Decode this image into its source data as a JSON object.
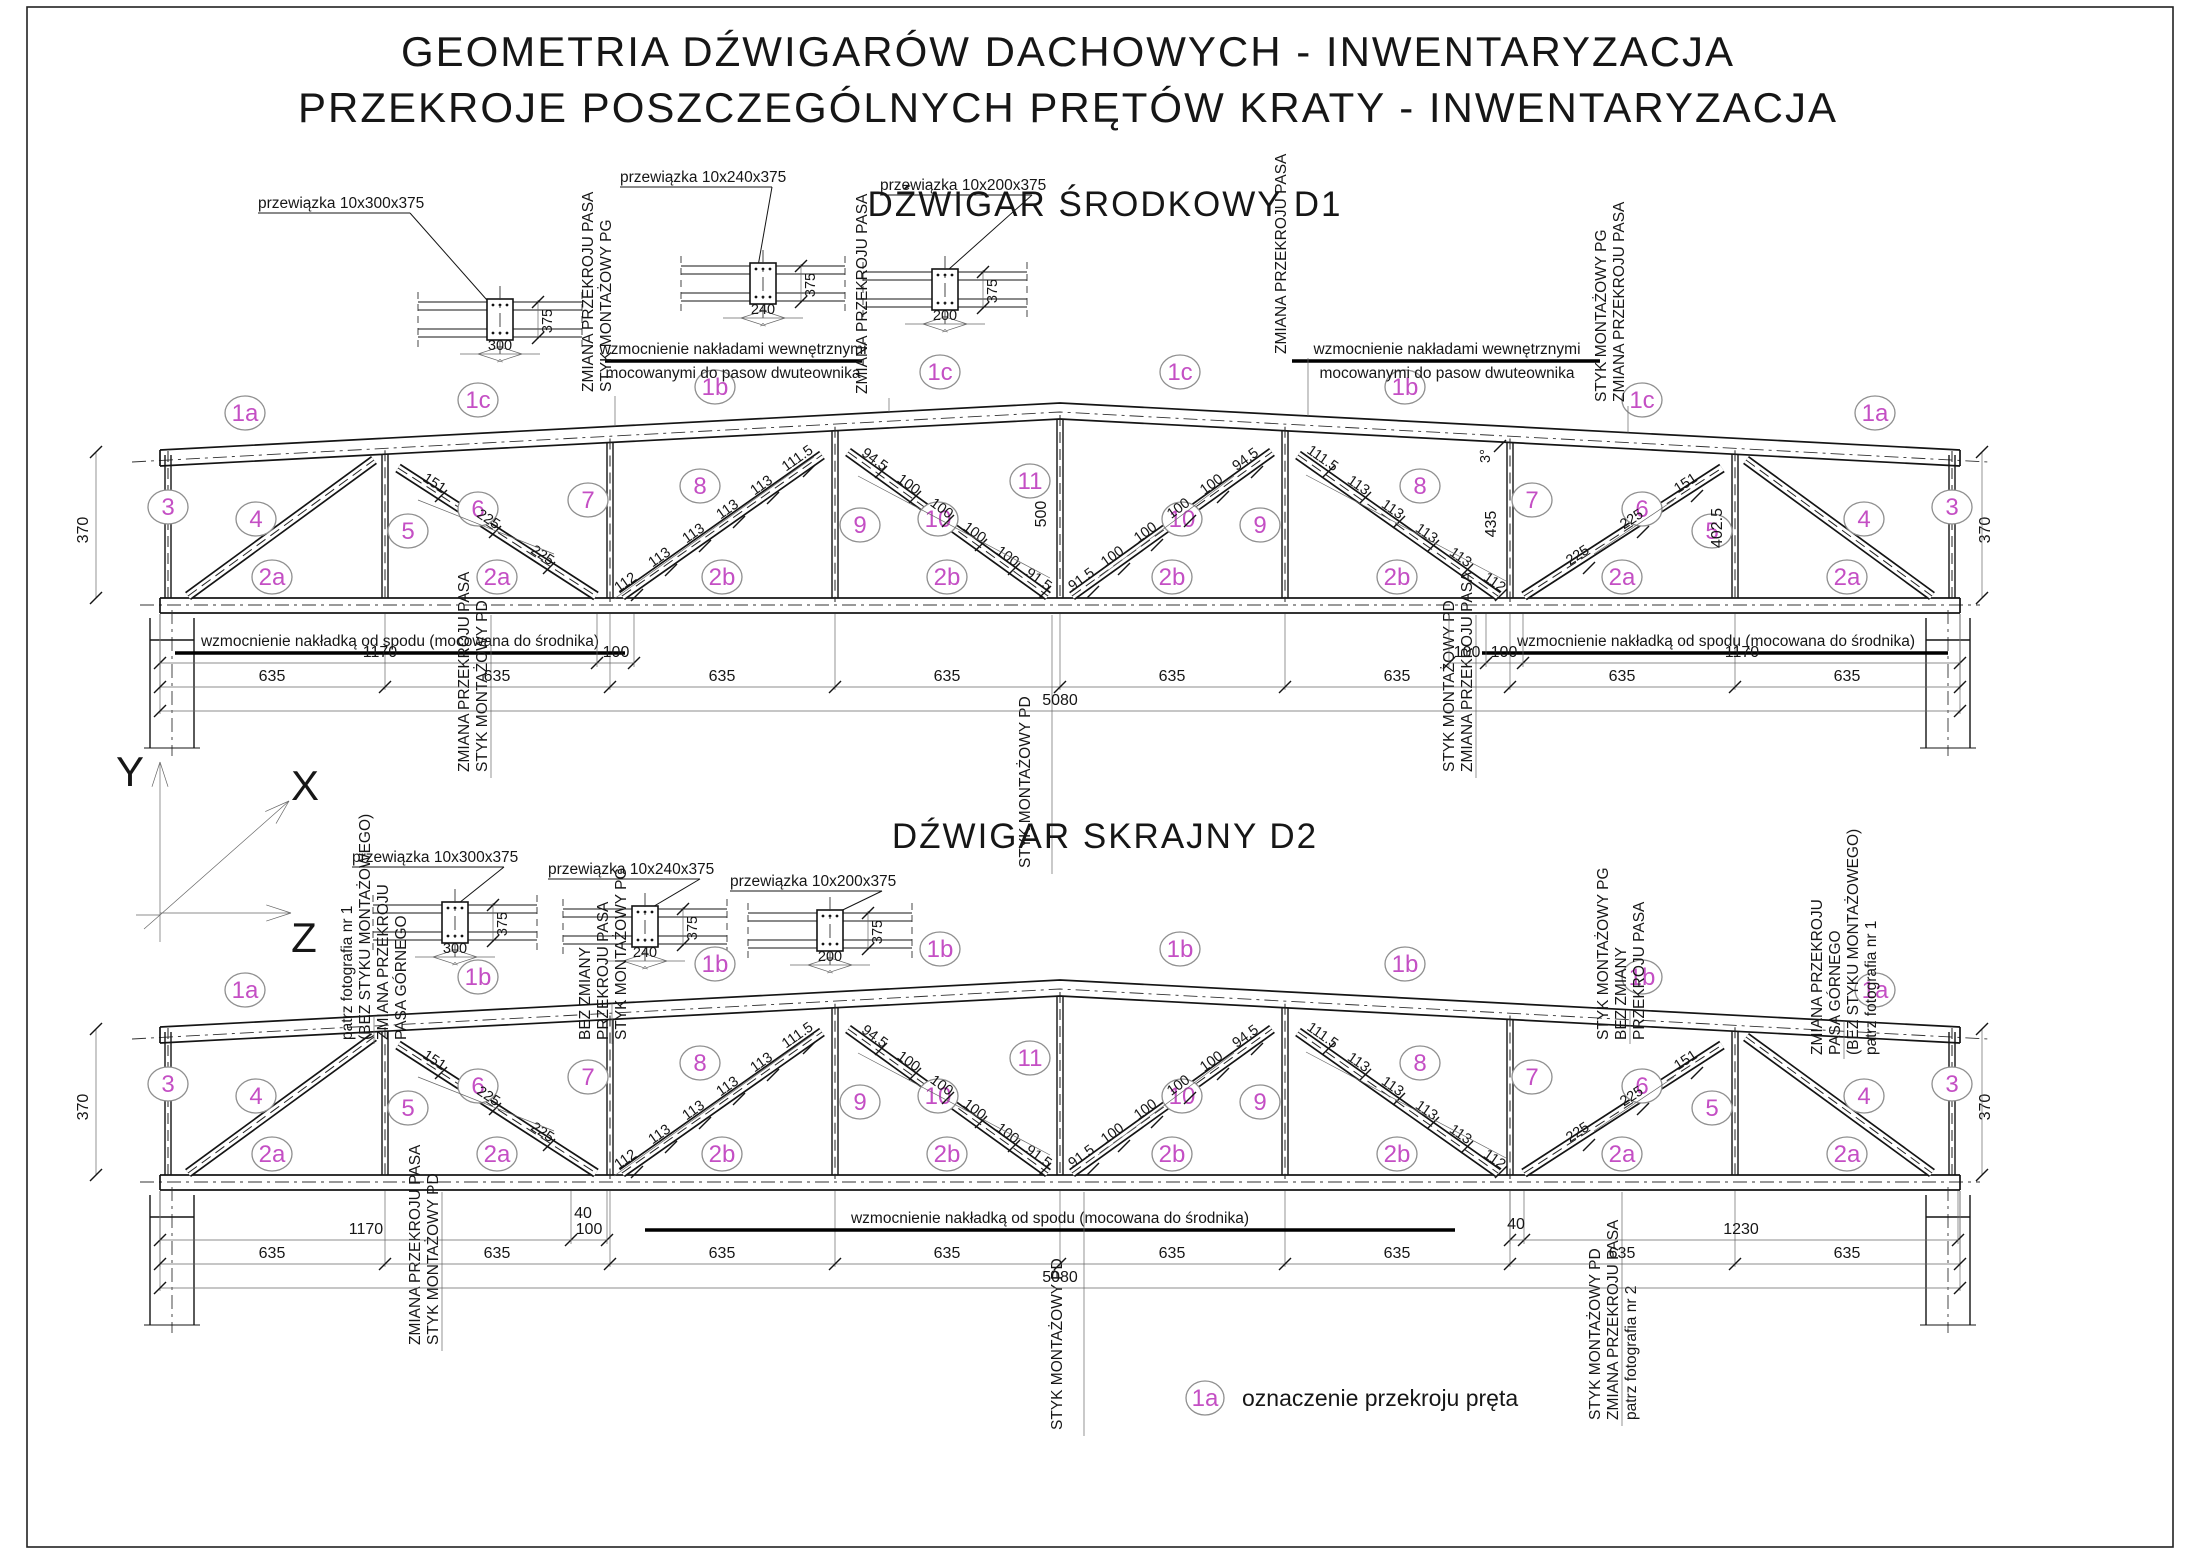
{
  "drawing": {
    "accent_color": "#c44fc4",
    "title_line1": "GEOMETRIA  DŹWIGARÓW  DACHOWYCH - INWENTARYZACJA",
    "title_line2": "PRZEKROJE POSZCZEGÓLNYCH  PRĘTÓW  KRATY - INWENTARYZACJA",
    "axes": {
      "y": "Y",
      "x": "X",
      "z": "Z"
    },
    "legend": {
      "bubble": "1a",
      "label": "oznaczenie  przekroju  pręta"
    }
  },
  "trusses": [
    {
      "name": "D1",
      "title": "DŹWIGAR  ŚRODKOWY  D1",
      "callouts": [
        {
          "label": "przewiązka 10x300x375",
          "width_dim": "300",
          "height_dim": "375"
        },
        {
          "label": "przewiązka 10x240x375",
          "width_dim": "240",
          "height_dim": "375"
        },
        {
          "label": "przewiązka 10x200x375",
          "width_dim": "200",
          "height_dim": "375"
        }
      ],
      "top_chord_labels": [
        "1a",
        "1c",
        "1b",
        "1c",
        "1c",
        "1b",
        "1c",
        "1a"
      ],
      "bottom_chord_labels": [
        "2a",
        "2a",
        "2b",
        "2b",
        "2b",
        "2b",
        "2a",
        "2a"
      ],
      "member_labels": [
        "3",
        "4",
        "5",
        "6",
        "7",
        "8",
        "9",
        "10",
        "11",
        "10",
        "9",
        "8",
        "7",
        "6",
        "5",
        "4",
        "3"
      ],
      "reinforce_top_note_l1": "wzmocnienie  nakładami  wewnętrznymi",
      "reinforce_top_note_l2": "mocowanymi do pasow dwuteownika",
      "reinforce_bottom_note": "wzmocnienie  nakładką od spodu (mocowana do środnika)",
      "vertical_notes": [
        [
          "ZMIANA PRZEKROJU PASA",
          "STYK  MONTAŻOWY  PG"
        ],
        [
          "ZMIANA  PRZEKROJU PASA"
        ],
        [
          "ZMIANA PRZEKROJU PASA"
        ],
        [
          "STYK  MONTAŻOWY  PG",
          "ZMIANA PRZEKROJU PASA"
        ],
        [
          "ZMIANA PRZEKROJU PASA",
          "STYK  MONTAŻOWY  PD"
        ],
        [
          "STYK  MONTAŻOWY  PD"
        ],
        [
          "STYK  MONTAŻOWY  PD",
          "ZMIANA PRZEKROJU PASA"
        ]
      ],
      "height_dims": [
        "370",
        "435",
        "500",
        "402.5",
        "370"
      ],
      "slope_dim": "3°",
      "batten_chains": {
        "left_diag_6": [
          "151",
          "225",
          "225"
        ],
        "left_diag_8": [
          "112",
          "113",
          "113",
          "113",
          "113",
          "111.5"
        ],
        "left_diag_10": [
          "94.5",
          "100",
          "100",
          "100",
          "100",
          "91.5"
        ],
        "right_diag_10": [
          "94.5",
          "100",
          "100",
          "100",
          "100",
          "91.5"
        ],
        "right_diag_8": [
          "111.5",
          "113",
          "113",
          "113",
          "113",
          "112"
        ],
        "right_diag_6": [
          "151",
          "225",
          "225"
        ]
      },
      "dim_rows": {
        "row1_left": [
          "1170",
          "100"
        ],
        "row1_right": [
          "100",
          "100",
          "1170"
        ],
        "row2": [
          "635",
          "635",
          "635",
          "635",
          "635",
          "635",
          "635",
          "635"
        ],
        "total": "5080"
      }
    },
    {
      "name": "D2",
      "title": "DŹWIGAR  SKRAJNY  D2",
      "callouts": [
        {
          "label": "przewiązka 10x300x375",
          "width_dim": "300",
          "height_dim": "375"
        },
        {
          "label": "przewiązka 10x240x375",
          "width_dim": "240",
          "height_dim": "375"
        },
        {
          "label": "przewiązka 10x200x375",
          "width_dim": "200",
          "height_dim": "375"
        }
      ],
      "top_chord_labels": [
        "1a",
        "1b",
        "1b",
        "1b",
        "1b",
        "1b",
        "1b",
        "1a"
      ],
      "bottom_chord_labels": [
        "2a",
        "2a",
        "2b",
        "2b",
        "2b",
        "2b",
        "2a",
        "2a"
      ],
      "member_labels": [
        "3",
        "4",
        "5",
        "6",
        "7",
        "8",
        "9",
        "10",
        "11",
        "10",
        "9",
        "8",
        "7",
        "6",
        "5",
        "4",
        "3"
      ],
      "reinforce_bottom_note": "wzmocnienie  nakładką od spodu (mocowana do środnika)",
      "vertical_notes": [
        [
          "patrz fotografia nr 1",
          "(BEZ  STYKU  MONTAŻOWEGO)",
          "ZMIANA PRZEKROJU",
          "PASA GÓRNEGO"
        ],
        [
          "BEZ ZMIANY",
          "PRZEKROJU PASA",
          "STYK  MONTAŻOWY  PG"
        ],
        [
          "STYK  MONTAŻOWY  PG",
          "BEZ ZMIANY",
          "PRZEKROJU PASA"
        ],
        [
          "ZMIANA PRZEKROJU",
          "PASA GÓRNEGO",
          "(BEZ  STYKU  MONTAŻOWEGO)",
          "patrz fotografia nr 1"
        ],
        [
          "ZMIANA PRZEKROJU PASA",
          "STYK  MONTAŻOWY  PD"
        ],
        [
          "STYK  MONTAŻOWY  PD"
        ],
        [
          "STYK  MONTAŻOWY  PD",
          "ZMIANA PRZEKROJU PASA",
          "patrz fotografia nr 2"
        ]
      ],
      "height_dims": [
        "370",
        "370"
      ],
      "batten_chains": {
        "left_diag_6": [
          "151",
          "225",
          "225"
        ],
        "left_diag_8": [
          "112",
          "113",
          "113",
          "113",
          "113",
          "111.5"
        ],
        "left_diag_10": [
          "94.5",
          "100",
          "100",
          "100",
          "100",
          "91.5"
        ],
        "right_diag_10": [
          "94.5",
          "100",
          "100",
          "100",
          "100",
          "91.5"
        ],
        "right_diag_8": [
          "111.5",
          "113",
          "113",
          "113",
          "113",
          "112"
        ],
        "right_diag_6": [
          "151",
          "225",
          "225"
        ]
      },
      "dim_rows": {
        "row1_left": [
          "1170",
          "100",
          "40"
        ],
        "row1_right": [
          "40",
          "1230"
        ],
        "row2": [
          "635",
          "635",
          "635",
          "635",
          "635",
          "635",
          "635",
          "635"
        ],
        "total": "5080"
      }
    }
  ]
}
